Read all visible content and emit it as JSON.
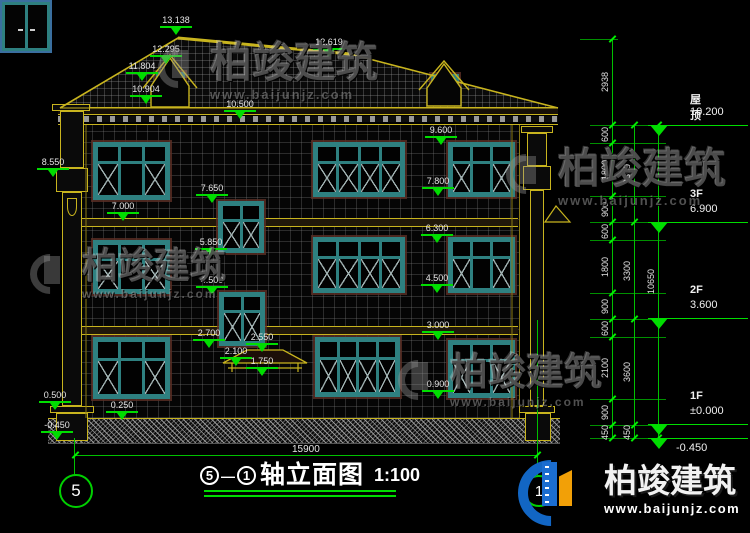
{
  "watermark": {
    "brand": "柏竣建筑",
    "url": "www.baijunjz.com"
  },
  "logo": {
    "brand": "柏竣建筑",
    "url": "www.baijunjz.com"
  },
  "title": {
    "axis_start": "5",
    "separator": "—",
    "axis_end": "1",
    "name": "轴立面图",
    "scale": "1:100"
  },
  "axis_bubbles": {
    "left": "5",
    "right": "1"
  },
  "dimensions": {
    "total_width": "15900",
    "elevation_markers": [
      "13.138",
      "12.295",
      "11.804",
      "10.904",
      "12.619",
      "10.500",
      "8.550",
      "9.600",
      "7.800",
      "7.650",
      "7.000",
      "6.300",
      "5.850",
      "4.500",
      "4.500",
      "3.000",
      "2.700",
      "2.550",
      "2.100",
      "1.750",
      "0.900",
      "0.500",
      "0.250",
      "-0.450"
    ],
    "chain_inner": [
      "2938",
      "600",
      "1800",
      "900",
      "600",
      "1800",
      "900",
      "600",
      "2100",
      "900",
      "450"
    ],
    "chain_mid": [
      "3300",
      "3300",
      "3600",
      "450"
    ],
    "chain_total": [
      "10650"
    ],
    "levels": [
      {
        "floor": "屋顶",
        "value": "10.200"
      },
      {
        "floor": "3F",
        "value": "6.900"
      },
      {
        "floor": "2F",
        "value": "3.600"
      },
      {
        "floor": "1F",
        "value": "±0.000"
      },
      {
        "floor": "",
        "value": "-0.450"
      }
    ]
  },
  "colors": {
    "dim_green": "#00dd00",
    "outline_yellow": "#c8b41e",
    "window_teal": "#2e8080",
    "logo_blue": "#1266c4",
    "logo_orange": "#f2a007"
  }
}
